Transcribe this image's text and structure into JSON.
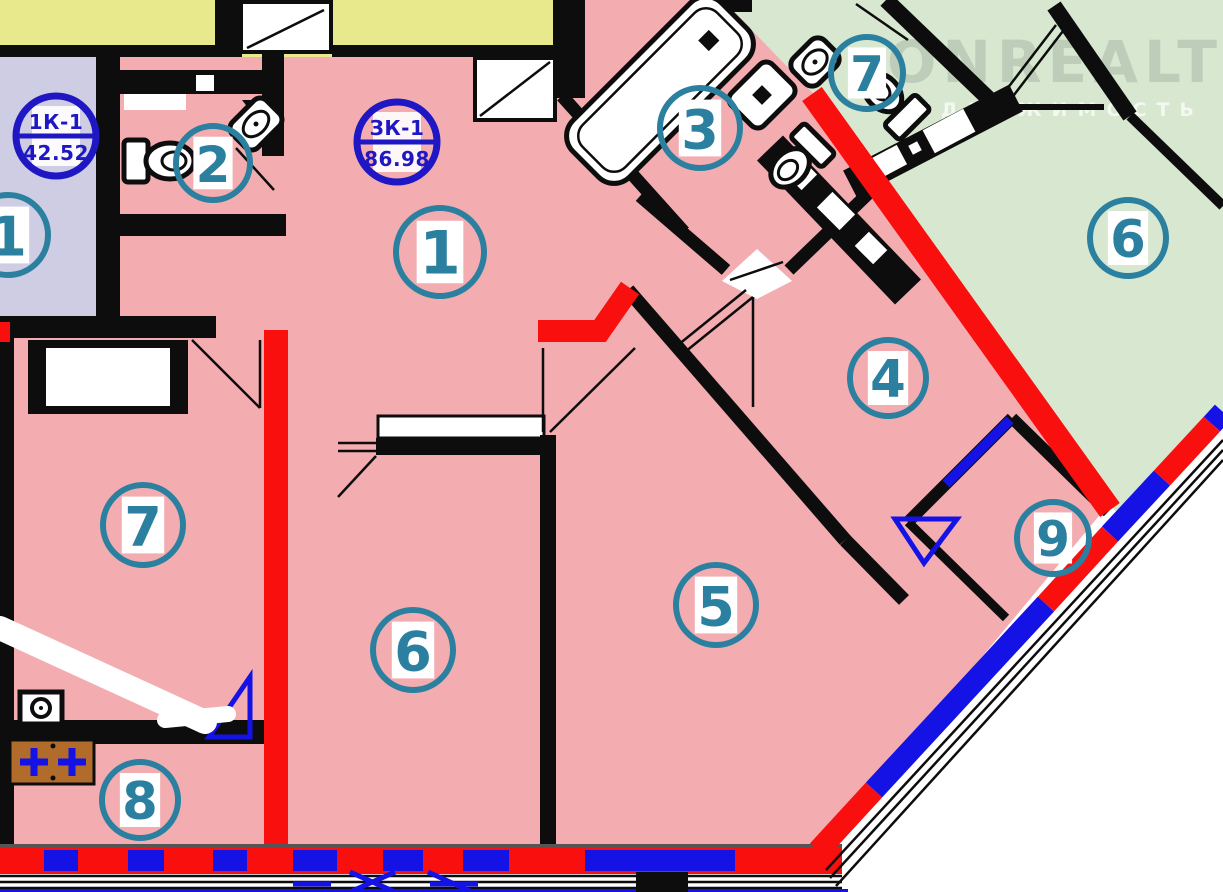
{
  "plan": {
    "title": "apartment-floor-plan",
    "watermark": {
      "title": "ONREALT",
      "subtitle": "НЕДВИЖИМОСТЬ"
    },
    "stamps": [
      {
        "code": "1К-1",
        "area": "42.52",
        "x": 56,
        "y": 136
      },
      {
        "code": "ЗК-1",
        "area": "86.98",
        "x": 397,
        "y": 142
      }
    ],
    "rooms": [
      {
        "number": "1",
        "x": 440,
        "y": 252,
        "r": 44
      },
      {
        "number": "2",
        "x": 213,
        "y": 163,
        "r": 37
      },
      {
        "number": "3",
        "x": 700,
        "y": 128,
        "r": 40
      },
      {
        "number": "7",
        "x": 867,
        "y": 73,
        "r": 36
      },
      {
        "number": "6",
        "x": 1128,
        "y": 238,
        "r": 38
      },
      {
        "number": "4",
        "x": 888,
        "y": 378,
        "r": 38
      },
      {
        "number": "9",
        "x": 1053,
        "y": 538,
        "r": 36
      },
      {
        "number": "1",
        "x": 8,
        "y": 235,
        "r": 40
      },
      {
        "number": "7",
        "x": 143,
        "y": 525,
        "r": 40
      },
      {
        "number": "6",
        "x": 413,
        "y": 650,
        "r": 40
      },
      {
        "number": "5",
        "x": 716,
        "y": 605,
        "r": 40
      },
      {
        "number": "8",
        "x": 140,
        "y": 800,
        "r": 38
      }
    ],
    "colors": {
      "pink": "#f3adb1",
      "lav": "#cfcde4",
      "yellow": "#e7e98c",
      "green": "#d7e7d0",
      "red": "#fa0f0f",
      "blue": "#1512e6",
      "teal": "#2b80a0",
      "stamp": "#1f17c4",
      "ink": "#0d0d0d",
      "brown": "#b16b2b",
      "wm1": "rgba(150,168,150,0.40)",
      "wm2": "rgba(255,255,255,0.70)"
    }
  }
}
